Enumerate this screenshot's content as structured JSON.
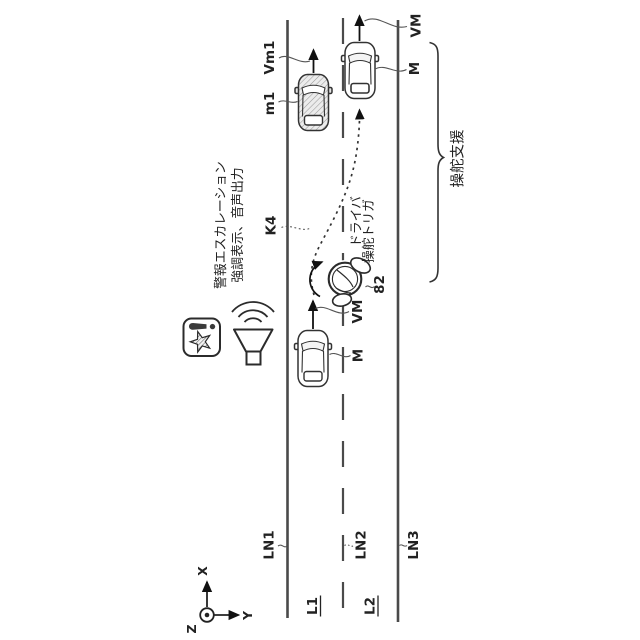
{
  "figure": {
    "road": {
      "line_labels": {
        "ln1": "LN1",
        "ln2": "LN2",
        "ln3": "LN3"
      },
      "lane_labels": {
        "l1": "L1",
        "l2": "L2"
      }
    },
    "vehicles": {
      "other": {
        "ref": "m1",
        "velocity": "Vm1"
      },
      "ego_after": {
        "ref": "M",
        "velocity": "VM"
      },
      "ego_before": {
        "ref": "M",
        "velocity": "VM"
      }
    },
    "trajectory_ref": "K4",
    "steering_wheel_ref": "82",
    "annotations": {
      "alert_escalation_line1": "警報エスカレーション",
      "alert_escalation_line2": "強調表示、音声出力",
      "driver_trigger_line1": "ドライバ",
      "driver_trigger_line2": "操舵トリガ",
      "steering_support": "操舵支援"
    },
    "axes": {
      "x": "X",
      "y": "Y",
      "z": "Z"
    },
    "colors": {
      "ink": "#2b2b2b",
      "road_line": "#4a4a4a",
      "background": "#ffffff"
    }
  }
}
